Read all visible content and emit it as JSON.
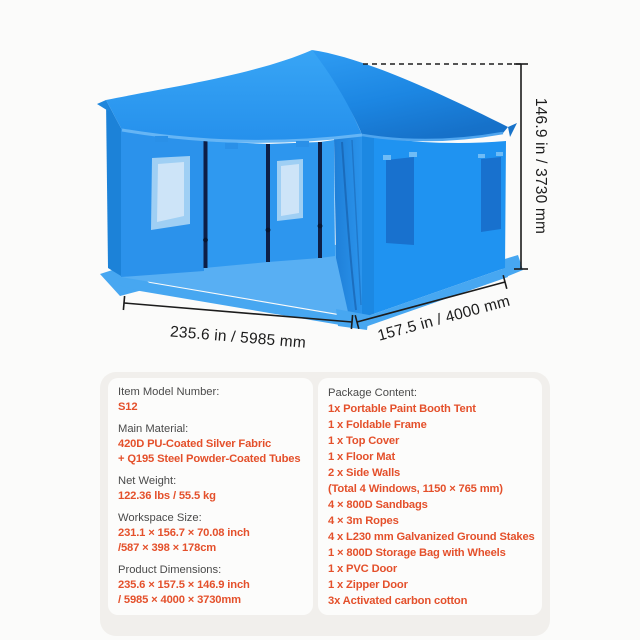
{
  "page": {
    "background": "#FBFBFA"
  },
  "colors": {
    "accent_orange": "#E4502B",
    "label_gray": "#4A4A4A",
    "dimension_ink": "#1C1C1C",
    "panel_bg": "#F1EFEC",
    "card_bg": "#FCFCFB",
    "tent_blue_main": "#2196F3",
    "tent_blue_deep": "#1670C8",
    "tent_window_light": "#C9E2F8",
    "tent_window_dark": "#1871CE"
  },
  "diagram": {
    "height_label": "146.9 in / 3730 mm",
    "width_label": "235.6 in / 5985 mm",
    "depth_label": "157.5 in / 4000 mm"
  },
  "specs": {
    "left": [
      {
        "label": "Item Model Number:",
        "values": [
          "S12"
        ]
      },
      {
        "label": "Main Material:",
        "values": [
          "420D PU-Coated Silver Fabric",
          "+ Q195 Steel Powder-Coated Tubes"
        ]
      },
      {
        "label": "Net Weight:",
        "values": [
          "122.36 lbs / 55.5 kg"
        ]
      },
      {
        "label": "Workspace Size:",
        "values": [
          "231.1 × 156.7 × 70.08 inch",
          "/587 × 398 × 178cm"
        ]
      },
      {
        "label": "Product Dimensions:",
        "values": [
          "235.6 × 157.5 × 146.9 inch",
          "/ 5985 × 4000 × 3730mm"
        ]
      }
    ],
    "package": {
      "label": "Package Content:",
      "items": [
        "1x Portable Paint Booth Tent",
        "1 x Foldable Frame",
        "1 x Top Cover",
        "1 x Floor Mat",
        "2 x Side Walls",
        "(Total 4 Windows, 1150 × 765 mm)",
        "4 × 800D Sandbags",
        "4 × 3m Ropes",
        "4 x L230 mm Galvanized Ground Stakes",
        "1 × 800D Storage Bag with Wheels",
        "1 x PVC Door",
        "1 x Zipper Door",
        "3x Activated carbon cotton"
      ]
    }
  }
}
